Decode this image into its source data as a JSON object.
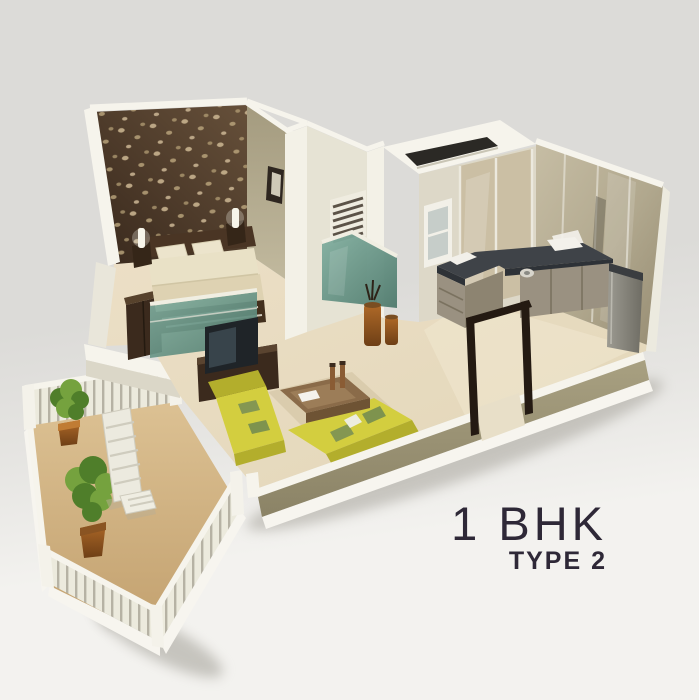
{
  "title": {
    "main": "1 BHK",
    "sub": "TYPE 2"
  },
  "scene": {
    "description": "3D isometric cutaway render of a 1 BHK Type 2 apartment unit on a light grey backdrop",
    "rooms": [
      {
        "name": "bedroom",
        "features": [
          "dark patterned accent wall",
          "double bed with cream bedding",
          "two pillows",
          "nightstands with lit lamps",
          "wall picture frame",
          "dark wardrobe",
          "teal glass partition at bed foot"
        ]
      },
      {
        "name": "bathroom",
        "features": [
          "white walls",
          "louvered vent window",
          "teal shower glass enclosure"
        ]
      },
      {
        "name": "wc",
        "features": [
          "white parapet roof with dark skylight slot"
        ]
      },
      {
        "name": "kitchen",
        "features": [
          "L-shaped charcoal countertop",
          "wood cabinets",
          "white sink",
          "hob burner",
          "tall refrigerator cabinet",
          "rear glass wall",
          "window"
        ]
      },
      {
        "name": "living-room",
        "features": [
          "two yellow sofas with green cushions",
          "brown coffee table with decor",
          "dark TV unit with television",
          "decorative floor vases"
        ]
      },
      {
        "name": "balcony",
        "features": [
          "white railing with balusters",
          "two potted plants",
          "white slatted lounge bench",
          "small side table",
          "tan floor"
        ]
      },
      {
        "name": "entrance",
        "features": [
          "open dark-brown door frame"
        ]
      }
    ]
  },
  "palette": {
    "bg-top": "#dcdbd8",
    "bg-bottom": "#f3f2ef",
    "text": "#2e2837",
    "accent-wall": "#4d382b",
    "accent-dot": "#c7b28e",
    "olive-wall": "#aaa286",
    "white-wall": "#f3f1e7",
    "parapet": "#f6f4ec",
    "floor": "#e8dfc8",
    "balcony-floor": "#d5b787",
    "counter": "#3f4348",
    "cabinet-wood": "#9a9181",
    "dark-wood": "#3b2a1d",
    "sofa": "#d3ce3f",
    "sofa-dark": "#b3ae2c",
    "cushion": "#849752",
    "table-wood": "#8a6b49",
    "glass-teal": "#6e9b8e",
    "plant": "#75a23e",
    "plant-dark": "#4f7e2a",
    "pot": "#a86226",
    "door-frame": "#241a12",
    "railing-slat": "#b6b2a4"
  }
}
